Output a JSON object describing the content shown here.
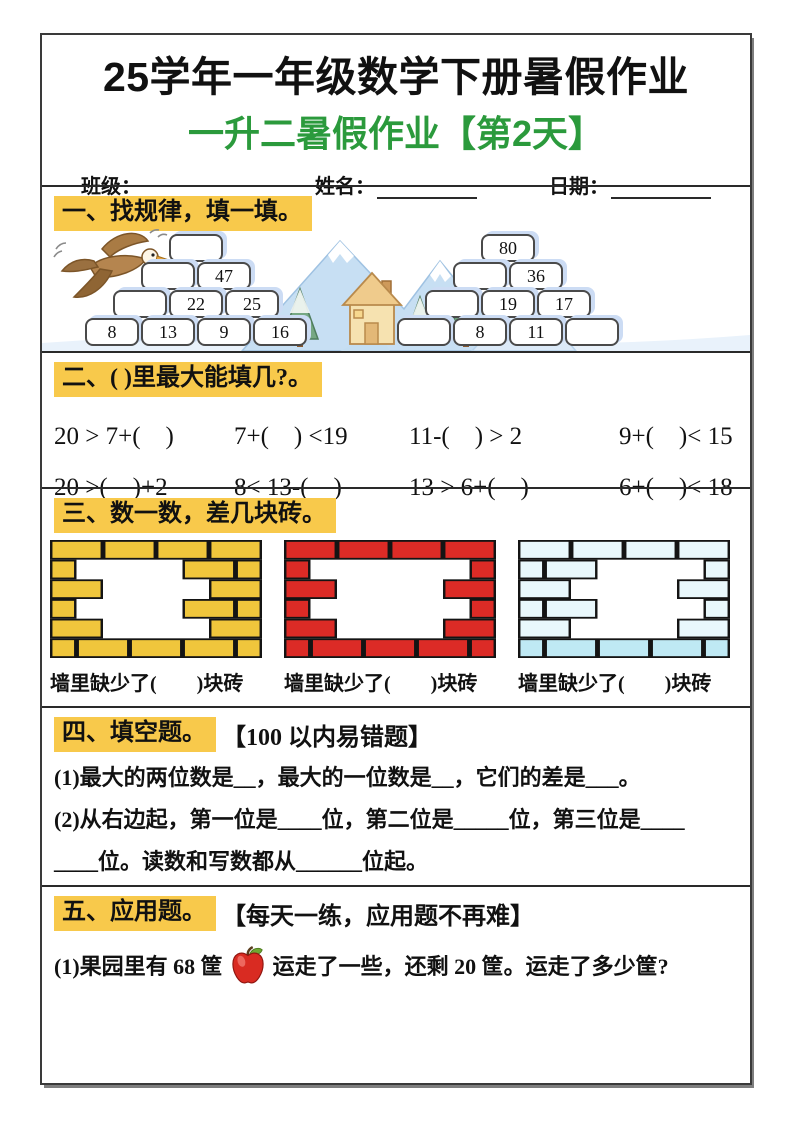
{
  "header": {
    "title": "25学年一年级数学下册暑假作业",
    "subtitle": "一升二暑假作业【第2天】",
    "subtitle_color": "#2B9A3C",
    "fields": [
      {
        "label": "班级："
      },
      {
        "label": "姓名："
      },
      {
        "label": "日期："
      }
    ]
  },
  "highlight_color": "#F8C94B",
  "sections": {
    "s1": {
      "title": "一、找规律，填一填。",
      "illustration_icons": [
        "eagle-icon",
        "mountains-icon",
        "house-icon",
        "pine-tree-icon",
        "snow-ground"
      ],
      "pyramids": [
        {
          "rows": [
            [
              ""
            ],
            [
              "",
              "47"
            ],
            [
              "",
              "22",
              "25"
            ],
            [
              "8",
              "13",
              "9",
              "16"
            ]
          ]
        },
        {
          "rows": [
            [
              "80"
            ],
            [
              "",
              "36"
            ],
            [
              "",
              "19",
              "17"
            ],
            [
              "",
              "8",
              "11",
              ""
            ]
          ]
        }
      ]
    },
    "s2": {
      "title": "二、( )里最大能填几?。",
      "rows": [
        [
          "20 > 7+(　)",
          "7+(　) <19",
          "11-(　) > 2",
          "9+(　)< 15"
        ],
        [
          "20 >(　)+2",
          "8< 13-(　)",
          "13 > 6+(　)",
          "6+(　)< 18"
        ]
      ]
    },
    "s3": {
      "title": "三、数一数，差几块砖。",
      "caption": "墙里缺少了(　　)块砖",
      "walls": [
        {
          "name": "yellow-wall",
          "color": "#F0C63C",
          "hole": {
            "1": [
              45,
              135
            ],
            "2": [
              30,
              150
            ],
            "3": [
              45,
              120
            ],
            "4": [
              60,
              160
            ]
          }
        },
        {
          "name": "red-wall",
          "color": "#DC2B26",
          "hole": {
            "1": [
              40,
              170
            ],
            "2": [
              30,
              180
            ],
            "3": [
              45,
              185
            ],
            "4": [
              55,
              150
            ]
          }
        },
        {
          "name": "blue-wall",
          "color": "#E9F8FC",
          "bottom": "#BFE9F4",
          "hole": {
            "1": [
              70,
              190
            ],
            "2": [
              45,
              180
            ],
            "3": [
              70,
              195
            ],
            "4": [
              50,
              165
            ]
          }
        }
      ]
    },
    "s4": {
      "title": "四、填空题。",
      "suffix": "【100 以内易错题】",
      "lines": [
        "(1)最大的两位数是__，最大的一位数是__，它们的差是___。",
        "(2)从右边起，第一位是____位，第二位是_____位，第三位是____",
        "____位。读数和写数都从______位起。"
      ]
    },
    "s5": {
      "title": "五、应用题。",
      "suffix": "【每天一练，应用题不再难】",
      "q1": {
        "before": "(1)果园里有 68 筐",
        "icon": "apple-icon",
        "after": "运走了一些，还剩 20 筐。运走了多少筐?"
      }
    }
  }
}
